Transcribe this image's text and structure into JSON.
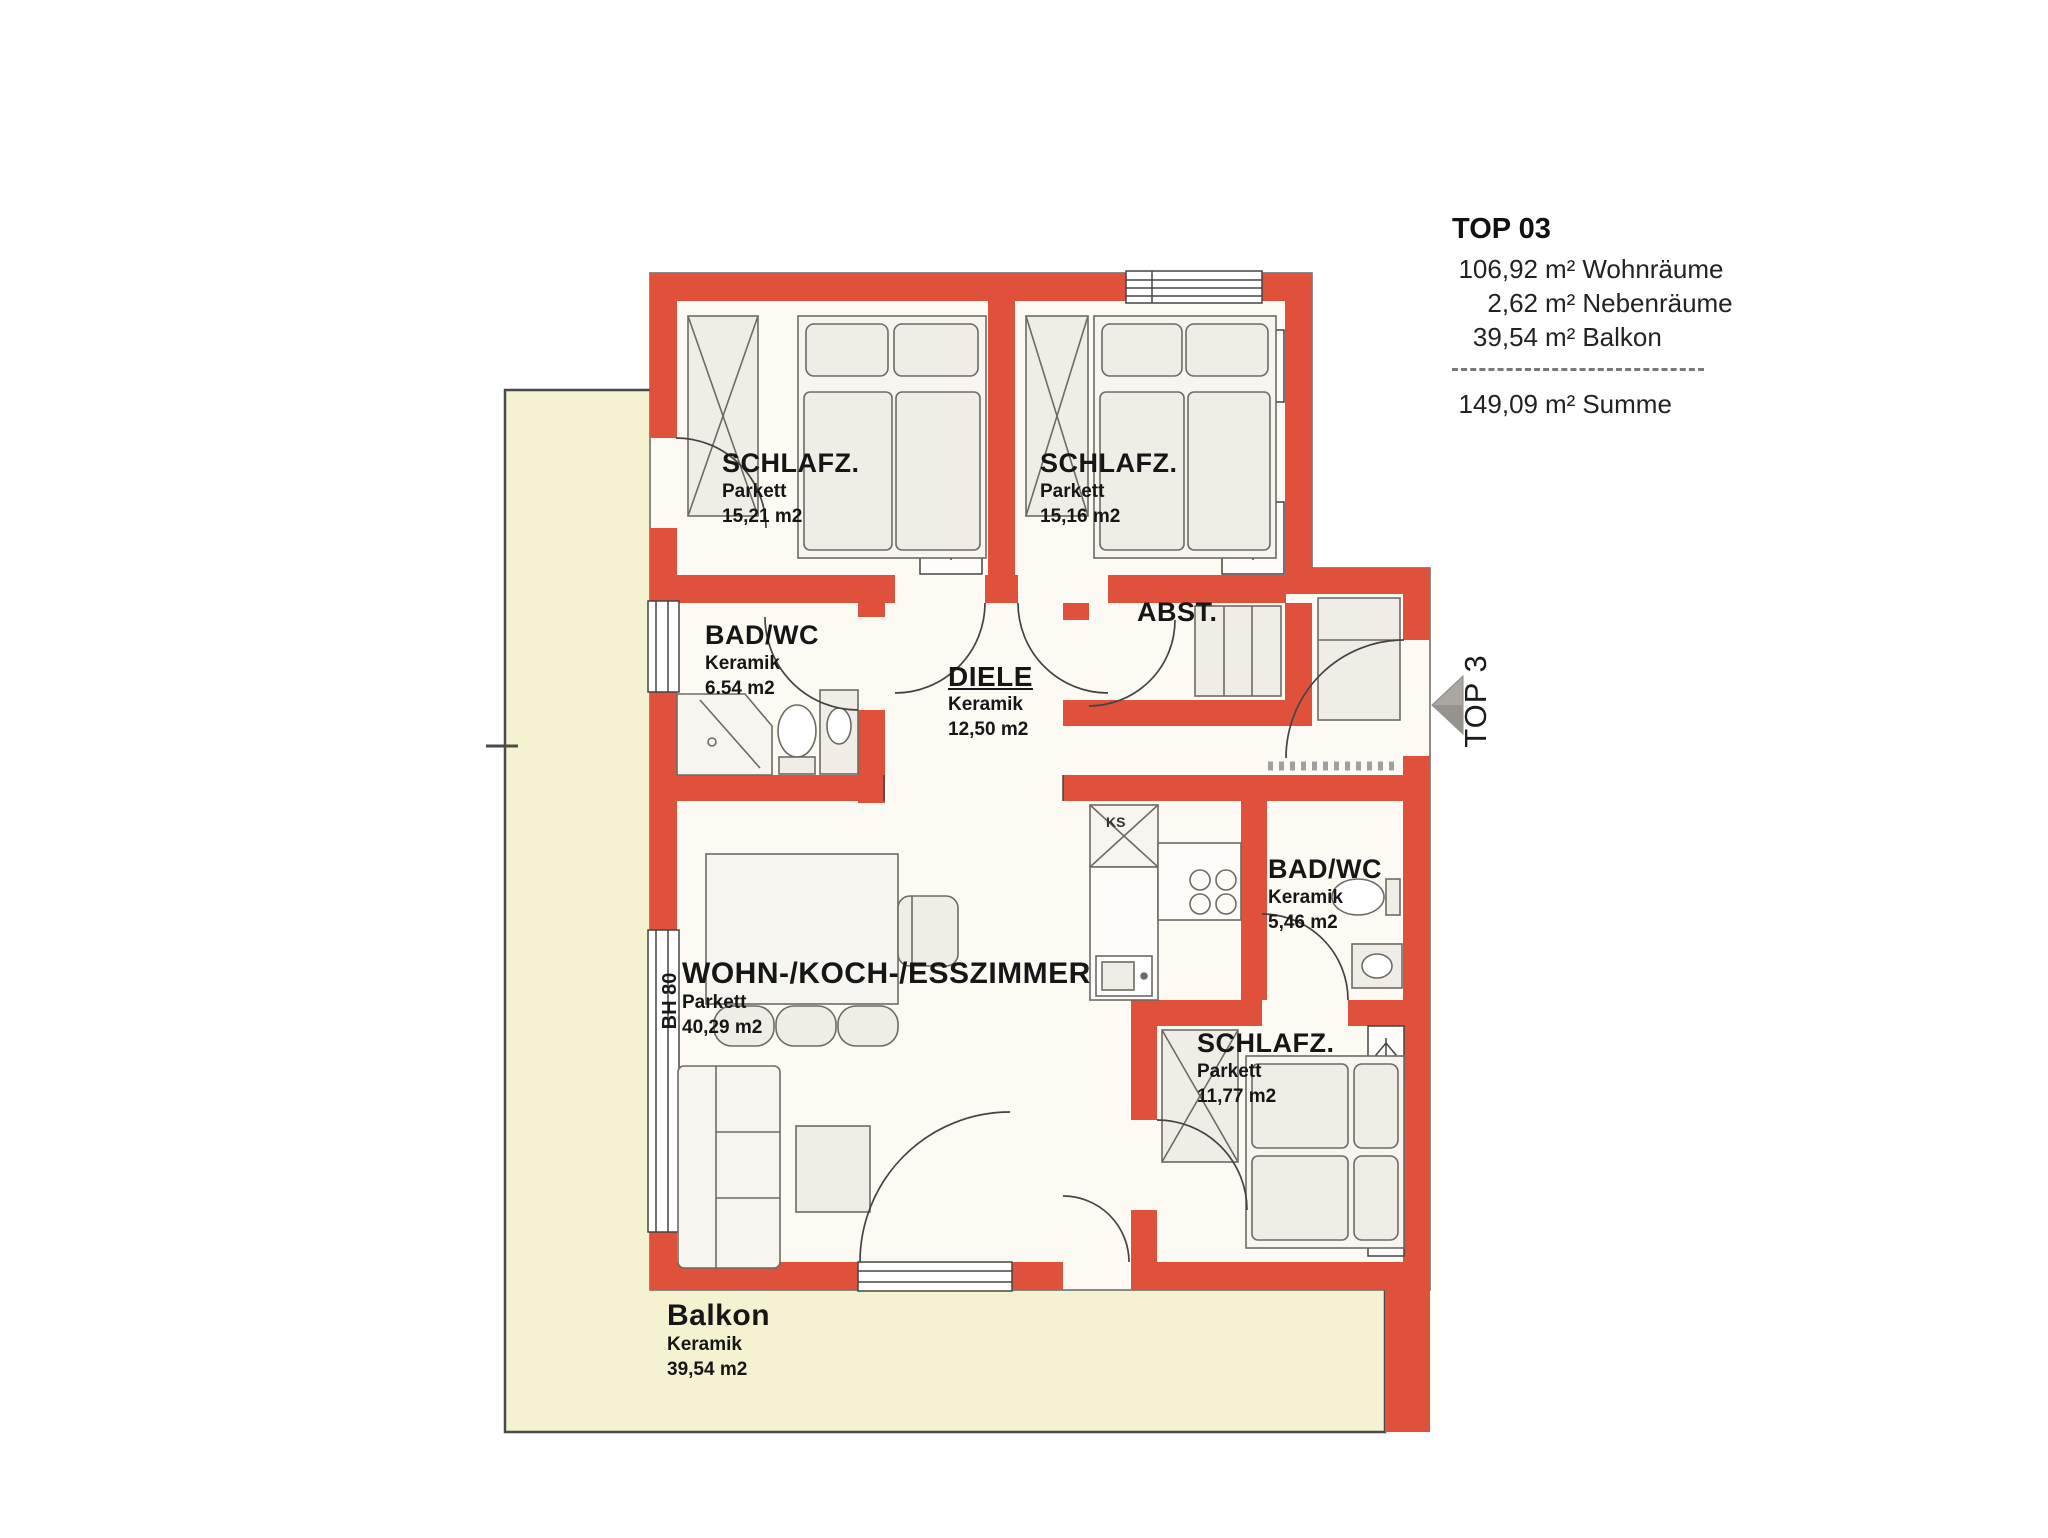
{
  "info": {
    "title": "TOP 03",
    "lines": [
      {
        "value": "106,92",
        "unit": "m²",
        "label": "Wohnräume"
      },
      {
        "value": "2,62",
        "unit": "m²",
        "label": "Nebenräume"
      },
      {
        "value": "39,54",
        "unit": "m²",
        "label": "Balkon"
      }
    ],
    "total": {
      "value": "149,09",
      "unit": "m²",
      "label": "Summe"
    }
  },
  "rooms": {
    "schlafz1": {
      "name": "SCHLAFZ.",
      "floor": "Parkett",
      "area": "15,21 m2"
    },
    "schlafz2": {
      "name": "SCHLAFZ.",
      "floor": "Parkett",
      "area": "15,16 m2"
    },
    "bad1": {
      "name": "BAD/WC",
      "floor": "Keramik",
      "area": "6.54 m2"
    },
    "diele": {
      "name": "DIELE",
      "floor": "Keramik",
      "area": "12,50 m2"
    },
    "abst": {
      "name": "ABST."
    },
    "wohn": {
      "name": "WOHN-/KOCH-/ESSZIMMER",
      "floor": "Parkett",
      "area": "40,29 m2"
    },
    "bad2": {
      "name": "BAD/WC",
      "floor": "Keramik",
      "area": "5,46 m2"
    },
    "schlafz3": {
      "name": "SCHLAFZ.",
      "floor": "Parkett",
      "area": "11,77 m2"
    },
    "balkon": {
      "name": "Balkon",
      "floor": "Keramik",
      "area": "39,54 m2"
    }
  },
  "annotations": {
    "unit_arrow": "TOP 3",
    "bh": "BH 80",
    "ks": "KS"
  },
  "colors": {
    "wall": "#e0513b",
    "balcony": "#f5f2d2",
    "floor": "#fcfaf3"
  }
}
